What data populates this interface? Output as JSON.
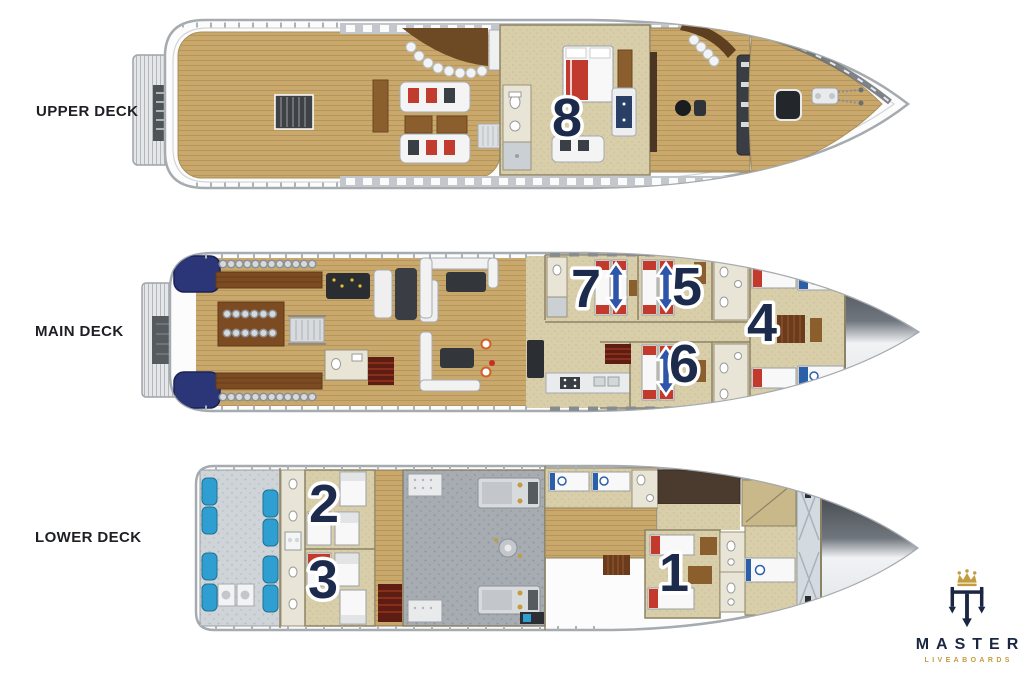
{
  "decks": [
    {
      "id": "upper-deck",
      "label": "UPPER DECK",
      "cabins": [
        {
          "number": "8"
        }
      ]
    },
    {
      "id": "main-deck",
      "label": "MAIN DECK",
      "cabins": [
        {
          "number": "7"
        },
        {
          "number": "5"
        },
        {
          "number": "6"
        },
        {
          "number": "4"
        }
      ]
    },
    {
      "id": "lower-deck",
      "label": "LOWER DECK",
      "cabins": [
        {
          "number": "2"
        },
        {
          "number": "3"
        },
        {
          "number": "1"
        }
      ]
    }
  ],
  "logo": {
    "brand": "MASTER",
    "tagline": "LIVEABOARDS"
  },
  "colors": {
    "background": "#FFFFFF",
    "numeral_navy": "#1C2A4B",
    "logo_navy": "#1B2742",
    "logo_gold": "#C49B3F",
    "arrow_blue": "#2F55A8",
    "stern_locker_navy": "#2B3678",
    "equipment_blue": "#2E9FD0",
    "deck_wood_tan": "#C9A86C",
    "cabin_floor_beige": "#D9CEAA",
    "bed_accent_red": "#C3392C",
    "hull_gray": "#A6ABB0"
  }
}
